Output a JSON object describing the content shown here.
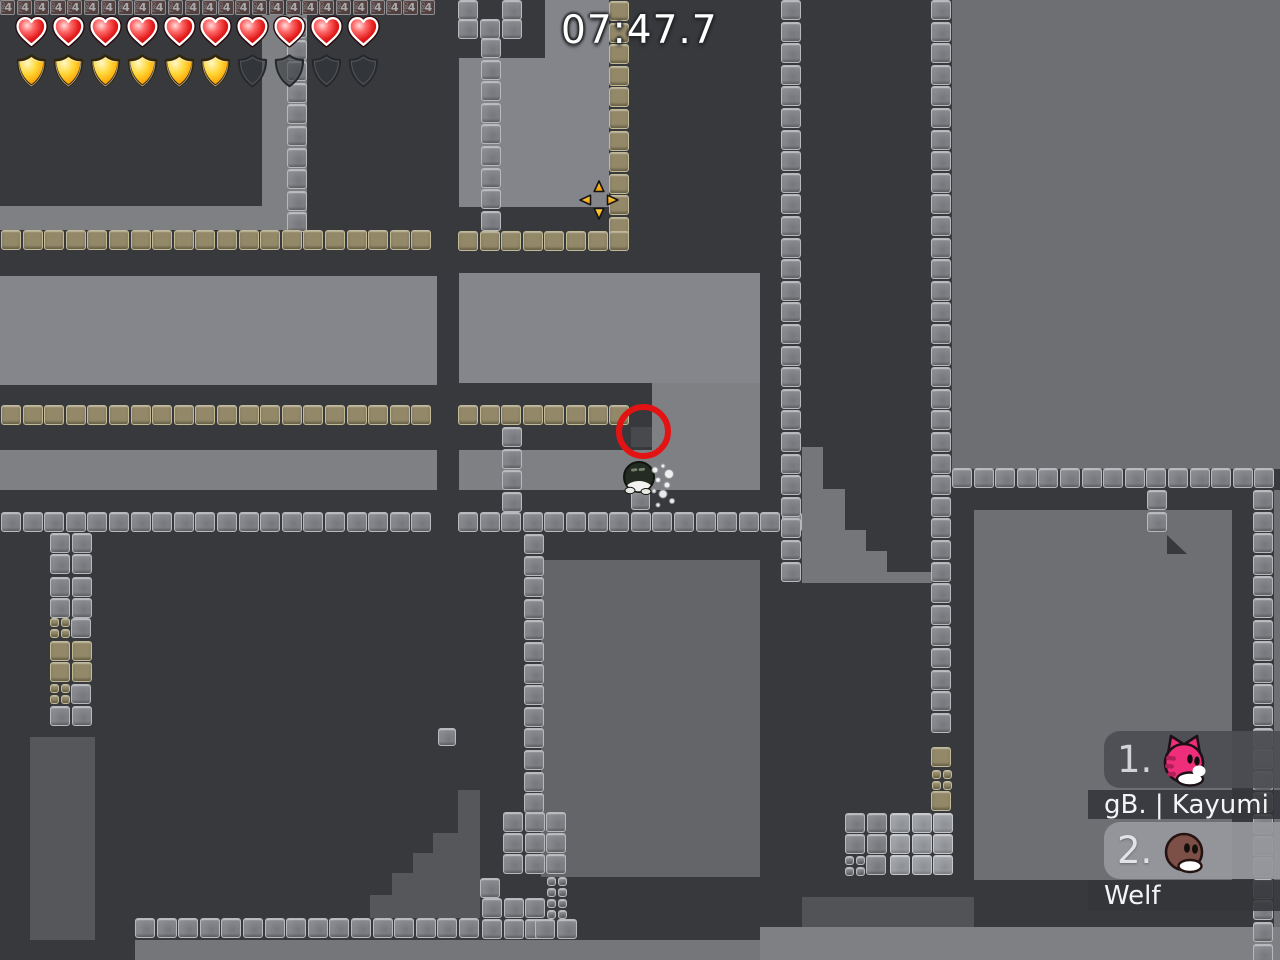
{
  "hud": {
    "timer": "07:47.7",
    "health": {
      "filled": 10,
      "total": 10
    },
    "armor": {
      "filled": 6,
      "total": 10
    }
  },
  "leaderboard": {
    "rows": [
      {
        "rank": "1.",
        "name": "gB. | Kayumi",
        "skin": "pink-cat"
      },
      {
        "rank": "2.",
        "name": "Welf",
        "skin": "brown-tee"
      }
    ]
  },
  "world": {
    "marker_number": "4",
    "marker_side_text": "FRO",
    "colors": {
      "wall": "#37393c",
      "air_light": "#85868b",
      "air_mid": "#7f8084",
      "air_right": "#6e6f73",
      "air_low": "#636568",
      "interior": "#55575a",
      "steel_tile": "#85878c",
      "tan_tile": "#938968",
      "circle_red": "#e41313",
      "crosshair_orange": "#f9a908",
      "timer_text": "#ffffff"
    },
    "air": [
      {
        "x": 262,
        "y": 15,
        "w": 45,
        "h": 215,
        "c": "#7f8084"
      },
      {
        "x": 0,
        "y": 206,
        "w": 262,
        "h": 24,
        "c": "#7f8084"
      },
      {
        "x": 459,
        "y": 58,
        "w": 86,
        "h": 149,
        "c": "#84858a"
      },
      {
        "x": 545,
        "y": 0,
        "w": 64,
        "h": 207,
        "c": "#84858a"
      },
      {
        "x": 0,
        "y": 276,
        "w": 437,
        "h": 109,
        "c": "#85868b"
      },
      {
        "x": 459,
        "y": 273,
        "w": 301,
        "h": 110,
        "c": "#85868b"
      },
      {
        "x": 652,
        "y": 383,
        "w": 108,
        "h": 67,
        "c": "#7f8084"
      },
      {
        "x": 0,
        "y": 450,
        "w": 437,
        "h": 40,
        "c": "#7f8084"
      },
      {
        "x": 459,
        "y": 450,
        "w": 301,
        "h": 40,
        "c": "#7f8084"
      },
      {
        "x": 802,
        "y": 447,
        "w": 21,
        "h": 136,
        "c": "#74767a"
      },
      {
        "x": 823,
        "y": 489,
        "w": 22,
        "h": 94,
        "c": "#74767a"
      },
      {
        "x": 845,
        "y": 530,
        "w": 21,
        "h": 53,
        "c": "#74767a"
      },
      {
        "x": 866,
        "y": 551,
        "w": 21,
        "h": 32,
        "c": "#74767a"
      },
      {
        "x": 887,
        "y": 572,
        "w": 45,
        "h": 11,
        "c": "#74767a"
      },
      {
        "x": 952,
        "y": 0,
        "w": 328,
        "h": 469,
        "c": "#6e6f73"
      },
      {
        "x": 974,
        "y": 510,
        "w": 258,
        "h": 370,
        "c": "#6e6f73"
      },
      {
        "x": 1274,
        "y": 490,
        "w": 6,
        "h": 470,
        "c": "#6e6f73"
      },
      {
        "x": 541,
        "y": 560,
        "w": 219,
        "h": 317,
        "c": "#636568"
      },
      {
        "x": 30,
        "y": 737,
        "w": 65,
        "h": 203,
        "c": "#55575a"
      },
      {
        "x": 458,
        "y": 790,
        "w": 22,
        "h": 128,
        "c": "#55575a"
      },
      {
        "x": 433,
        "y": 833,
        "w": 25,
        "h": 85,
        "c": "#55575a"
      },
      {
        "x": 413,
        "y": 853,
        "w": 20,
        "h": 65,
        "c": "#55575a"
      },
      {
        "x": 392,
        "y": 873,
        "w": 21,
        "h": 45,
        "c": "#55575a"
      },
      {
        "x": 370,
        "y": 895,
        "w": 22,
        "h": 23,
        "c": "#55575a"
      },
      {
        "x": 802,
        "y": 897,
        "w": 172,
        "h": 30,
        "c": "#515356"
      },
      {
        "x": 135,
        "y": 940,
        "w": 625,
        "h": 20,
        "c": "#75767a"
      },
      {
        "x": 760,
        "y": 927,
        "w": 520,
        "h": 33,
        "c": "#7e8084"
      },
      {
        "x": 631,
        "y": 427,
        "w": 21,
        "h": 20,
        "c": "#47494d"
      }
    ],
    "wedges": [
      {
        "x": 1167,
        "y": 535,
        "w": 20,
        "h": 19
      },
      {
        "x": 957,
        "y": 877,
        "w": 17,
        "h": 20
      }
    ],
    "strips": [
      {
        "t": "four",
        "x": 0,
        "y": 0,
        "n": 26,
        "s": 15.2
      },
      {
        "t": "steel",
        "x": 458,
        "y": 0,
        "n": 1
      },
      {
        "t": "steel",
        "x": 502,
        "y": 0,
        "n": 1
      },
      {
        "t": "steel",
        "x": 458,
        "y": 19,
        "n": 1
      },
      {
        "t": "steel",
        "x": 480,
        "y": 19,
        "n": 1
      },
      {
        "t": "steel",
        "x": 502,
        "y": 19,
        "n": 1
      },
      {
        "t": "steel",
        "x": 287,
        "y": 18,
        "n": 10,
        "d": "v"
      },
      {
        "t": "steel",
        "x": 481,
        "y": 38,
        "n": 9,
        "d": "v"
      },
      {
        "t": "tan",
        "x": 609,
        "y": 1,
        "n": 11,
        "d": "v"
      },
      {
        "t": "tan",
        "x": 1,
        "y": 230,
        "n": 20
      },
      {
        "t": "tan",
        "x": 458,
        "y": 231,
        "n": 8
      },
      {
        "t": "tan",
        "x": 1,
        "y": 405,
        "n": 20
      },
      {
        "t": "tan",
        "x": 458,
        "y": 405,
        "n": 8
      },
      {
        "t": "steel",
        "x": 1,
        "y": 512,
        "n": 20
      },
      {
        "t": "steel",
        "x": 458,
        "y": 512,
        "n": 16
      },
      {
        "t": "steel",
        "x": 502,
        "y": 427,
        "n": 4,
        "d": "v"
      },
      {
        "t": "steel",
        "x": 631,
        "y": 491,
        "n": 1,
        "s": 19
      },
      {
        "t": "steel",
        "x": 781,
        "y": 0,
        "n": 27,
        "d": "v"
      },
      {
        "t": "steel",
        "x": 931,
        "y": 0,
        "n": 34,
        "d": "v"
      },
      {
        "t": "tan",
        "x": 931,
        "y": 747,
        "n": 1
      },
      {
        "t": "tan",
        "x": 932,
        "y": 770,
        "n": 2,
        "s": 9
      },
      {
        "t": "tan",
        "x": 932,
        "y": 780.5,
        "n": 2,
        "s": 9
      },
      {
        "t": "tan",
        "x": 931,
        "y": 791,
        "n": 1
      },
      {
        "t": "steel",
        "x": 952,
        "y": 468,
        "n": 15
      },
      {
        "t": "steel",
        "x": 1253,
        "y": 490,
        "n": 22,
        "d": "v"
      },
      {
        "t": "steel",
        "x": 1147,
        "y": 490,
        "n": 2,
        "d": "v"
      },
      {
        "t": "steel",
        "x": 524,
        "y": 534,
        "n": 13,
        "d": "v"
      },
      {
        "t": "steel",
        "x": 50,
        "y": 533,
        "n": 2
      },
      {
        "t": "steel",
        "x": 50,
        "y": 554,
        "n": 2
      },
      {
        "t": "steel",
        "x": 50,
        "y": 577,
        "n": 2
      },
      {
        "t": "steel",
        "x": 50,
        "y": 598,
        "n": 2
      },
      {
        "t": "tan",
        "x": 50,
        "y": 618,
        "n": 2,
        "s": 9
      },
      {
        "t": "tan",
        "x": 50,
        "y": 629,
        "n": 2,
        "s": 9
      },
      {
        "t": "steel",
        "x": 71,
        "y": 618,
        "n": 1
      },
      {
        "t": "tan",
        "x": 50,
        "y": 641,
        "n": 2
      },
      {
        "t": "tan",
        "x": 50,
        "y": 662,
        "n": 2
      },
      {
        "t": "tan",
        "x": 50,
        "y": 684,
        "n": 2,
        "s": 9
      },
      {
        "t": "tan",
        "x": 50,
        "y": 695,
        "n": 2,
        "s": 9
      },
      {
        "t": "steel",
        "x": 71,
        "y": 684,
        "n": 1
      },
      {
        "t": "steel",
        "x": 50,
        "y": 706,
        "n": 2
      },
      {
        "t": "steel",
        "x": 438,
        "y": 728,
        "n": 1,
        "s": 18
      },
      {
        "t": "steel",
        "x": 503,
        "y": 812,
        "n": 3
      },
      {
        "t": "steel",
        "x": 503,
        "y": 833,
        "n": 3
      },
      {
        "t": "steel",
        "x": 503,
        "y": 854,
        "n": 3
      },
      {
        "t": "steel",
        "x": 480,
        "y": 878,
        "n": 1
      },
      {
        "t": "steel",
        "x": 482,
        "y": 898,
        "n": 3
      },
      {
        "t": "steel",
        "x": 482,
        "y": 919,
        "n": 3
      },
      {
        "t": "steel",
        "x": 547,
        "y": 877,
        "n": 2,
        "s": 9
      },
      {
        "t": "steel",
        "x": 547,
        "y": 888,
        "n": 2,
        "s": 9
      },
      {
        "t": "steel",
        "x": 547,
        "y": 899,
        "n": 2,
        "s": 9
      },
      {
        "t": "steel",
        "x": 547,
        "y": 910,
        "n": 2,
        "s": 9
      },
      {
        "t": "steel",
        "x": 135,
        "y": 918,
        "n": 16
      },
      {
        "t": "steel",
        "x": 535,
        "y": 919,
        "n": 2
      },
      {
        "t": "steel",
        "x": 845,
        "y": 813,
        "n": 2
      },
      {
        "t": "steel",
        "x": 845,
        "y": 834,
        "n": 2
      },
      {
        "t": "steel",
        "x": 845,
        "y": 856,
        "n": 2,
        "s": 9
      },
      {
        "t": "steel",
        "x": 845,
        "y": 867,
        "n": 2,
        "s": 9
      },
      {
        "t": "steel",
        "x": 866,
        "y": 855,
        "n": 1
      },
      {
        "t": "steelL",
        "x": 890,
        "y": 813,
        "n": 3
      },
      {
        "t": "steelL",
        "x": 890,
        "y": 834,
        "n": 3
      },
      {
        "t": "steelL",
        "x": 890,
        "y": 855,
        "n": 3
      }
    ]
  },
  "entities": {
    "player": {
      "x": 619,
      "y": 457
    },
    "red_circle": {
      "x": 616,
      "y": 404,
      "d": 55
    },
    "crosshair": {
      "x": 576,
      "y": 177
    },
    "particles": {
      "x": 645,
      "y": 460
    }
  }
}
